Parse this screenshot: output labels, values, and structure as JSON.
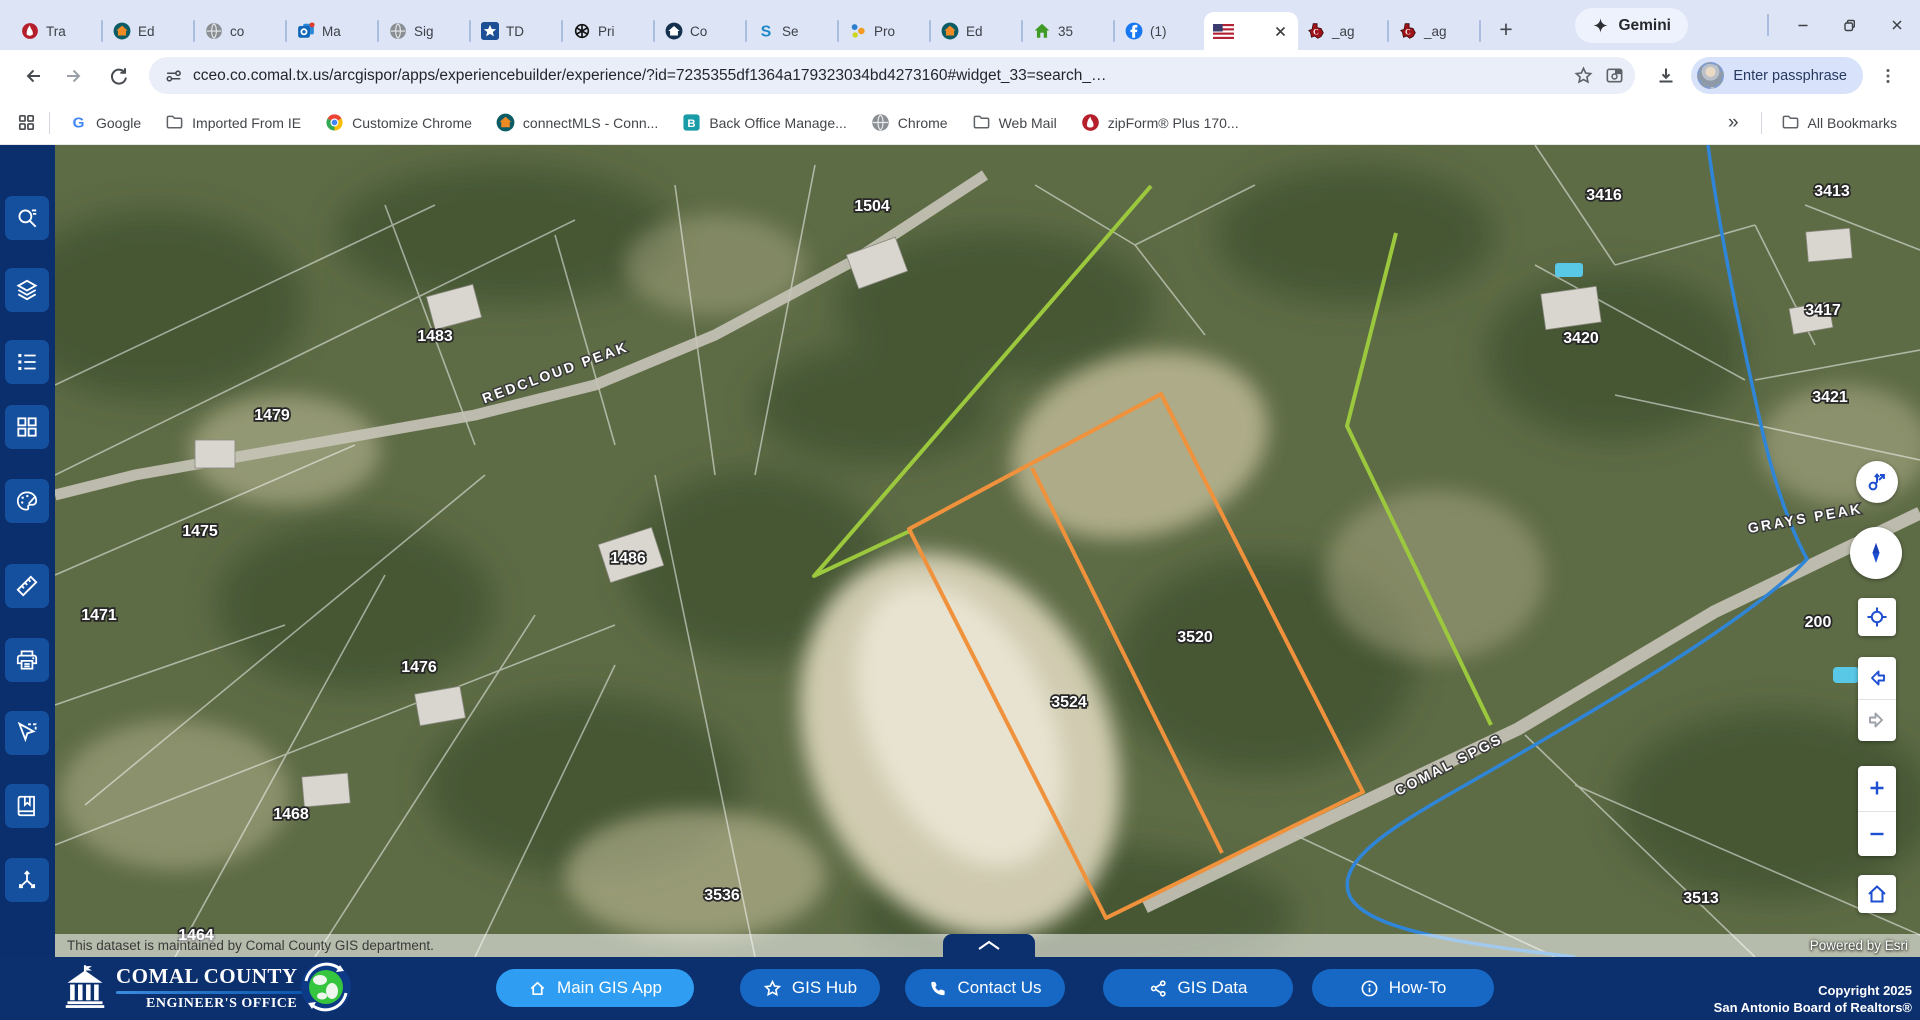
{
  "colors": {
    "sidebar_navy": "#0b2e6d",
    "sidebar_button": "#15509f",
    "footer_navy": "#0c2f6e",
    "primary_button": "#2e9df2",
    "secondary_button": "#1668c4",
    "parcel_orange": "#f0913c",
    "boundary_green": "#9cc83e",
    "stream_blue": "#2f86d8",
    "control_blue": "#1d4fd0"
  },
  "browser": {
    "tabs": [
      {
        "label": "Tra",
        "icon": "lonewolf"
      },
      {
        "label": "Ed",
        "icon": "connectmls"
      },
      {
        "label": "co",
        "icon": "globe"
      },
      {
        "label": "Ma",
        "icon": "outlook"
      },
      {
        "label": "Sig",
        "icon": "globe"
      },
      {
        "label": "TD",
        "icon": "starblue"
      },
      {
        "label": "Pri",
        "icon": "openai"
      },
      {
        "label": "Co",
        "icon": "homenavy"
      },
      {
        "label": "Se",
        "icon": "skyslope"
      },
      {
        "label": "Pro",
        "icon": "dots"
      },
      {
        "label": "Ed",
        "icon": "connectmls"
      },
      {
        "label": "35",
        "icon": "housegreen"
      },
      {
        "label": "(1)",
        "icon": "facebook"
      },
      {
        "label": "",
        "icon": "usflag",
        "active": true
      },
      {
        "label": "_ag",
        "icon": "texas"
      },
      {
        "label": "_ag",
        "icon": "texas"
      }
    ],
    "new_tab": "+",
    "gemini": "Gemini",
    "url": "cceo.co.comal.tx.us/arcgispor/apps/experiencebuilder/experience/?id=7235355df1364a179323034bd4273160#widget_33=search_…",
    "profile": "Enter passphrase",
    "bookmarks": [
      {
        "label": "Google",
        "icon": "googleg"
      },
      {
        "label": "Imported From IE",
        "icon": "folder"
      },
      {
        "label": "Customize Chrome",
        "icon": "chrome"
      },
      {
        "label": "connectMLS - Conn...",
        "icon": "connectmls"
      },
      {
        "label": "Back Office Manage...",
        "icon": "bteal"
      },
      {
        "label": "Chrome",
        "icon": "globe"
      },
      {
        "label": "Web Mail",
        "icon": "folder"
      },
      {
        "label": "zipForm® Plus 170...",
        "icon": "lonewolf"
      }
    ],
    "bookmarks_overflow": "»",
    "all_bookmarks": "All Bookmarks"
  },
  "sidebar_tools": [
    {
      "name": "search"
    },
    {
      "name": "layers"
    },
    {
      "name": "legend"
    },
    {
      "name": "basemaps"
    },
    {
      "name": "draw"
    },
    {
      "name": "measure"
    },
    {
      "name": "print"
    },
    {
      "name": "select"
    },
    {
      "name": "bookmarks"
    },
    {
      "name": "coordinates"
    }
  ],
  "map": {
    "parcel_labels": [
      {
        "text": "1504",
        "x": 817,
        "y": 66
      },
      {
        "text": "3416",
        "x": 1549,
        "y": 55
      },
      {
        "text": "3413",
        "x": 1777,
        "y": 51
      },
      {
        "text": "1483",
        "x": 380,
        "y": 196
      },
      {
        "text": "3417",
        "x": 1768,
        "y": 170
      },
      {
        "text": "3420",
        "x": 1526,
        "y": 198
      },
      {
        "text": "1479",
        "x": 217,
        "y": 275
      },
      {
        "text": "3421",
        "x": 1775,
        "y": 257
      },
      {
        "text": "1475",
        "x": 145,
        "y": 391
      },
      {
        "text": "1486",
        "x": 573,
        "y": 418
      },
      {
        "text": "1471",
        "x": 44,
        "y": 475
      },
      {
        "text": "200",
        "x": 1763,
        "y": 482
      },
      {
        "text": "1476",
        "x": 364,
        "y": 527
      },
      {
        "text": "3520",
        "x": 1140,
        "y": 497
      },
      {
        "text": "3524",
        "x": 1014,
        "y": 562
      },
      {
        "text": "1468",
        "x": 236,
        "y": 674
      },
      {
        "text": "3536",
        "x": 667,
        "y": 755
      },
      {
        "text": "3513",
        "x": 1646,
        "y": 758
      },
      {
        "text": "1464",
        "x": 141,
        "y": 795
      }
    ],
    "street_labels": [
      {
        "text": "REDCLOUD PEAK",
        "x": 502,
        "y": 232,
        "rot": -20
      },
      {
        "text": "GRAYS PEAK",
        "x": 1751,
        "y": 378,
        "rot": -10
      },
      {
        "text": "COMAL SPGS",
        "x": 1396,
        "y": 624,
        "rot": -27
      }
    ],
    "highlight_parcels": {
      "outer": "1106,249 1308,647 1051,773 854,384",
      "divider": "977,323 1167,708"
    },
    "green_boundary": [
      "1096,41 759,431 857,385",
      "1341,88 1292,281 1436,580"
    ],
    "attribution_left": "This dataset is maintained by Comal County GIS department.",
    "attribution_right": "Powered by Esri"
  },
  "map_controls": [
    {
      "name": "pan-mode"
    },
    {
      "name": "compass"
    },
    {
      "name": "locate"
    },
    {
      "name": "previous-extent"
    },
    {
      "name": "next-extent"
    },
    {
      "name": "zoom-in"
    },
    {
      "name": "zoom-out"
    },
    {
      "name": "home"
    }
  ],
  "footer": {
    "org_title": "COMAL COUNTY",
    "org_subtitle": "ENGINEER'S OFFICE",
    "buttons": [
      {
        "label": "Main GIS App",
        "icon": "home",
        "style": "primary"
      },
      {
        "label": "GIS Hub",
        "icon": "star",
        "style": "secondary"
      },
      {
        "label": "Contact Us",
        "icon": "phone",
        "style": "secondary"
      },
      {
        "label": "GIS Data",
        "icon": "share",
        "style": "secondary"
      },
      {
        "label": "How-To",
        "icon": "info",
        "style": "secondary"
      }
    ],
    "copyright_line1": "Copyright 2025",
    "copyright_line2": "San Antonio Board of Realtors®"
  }
}
